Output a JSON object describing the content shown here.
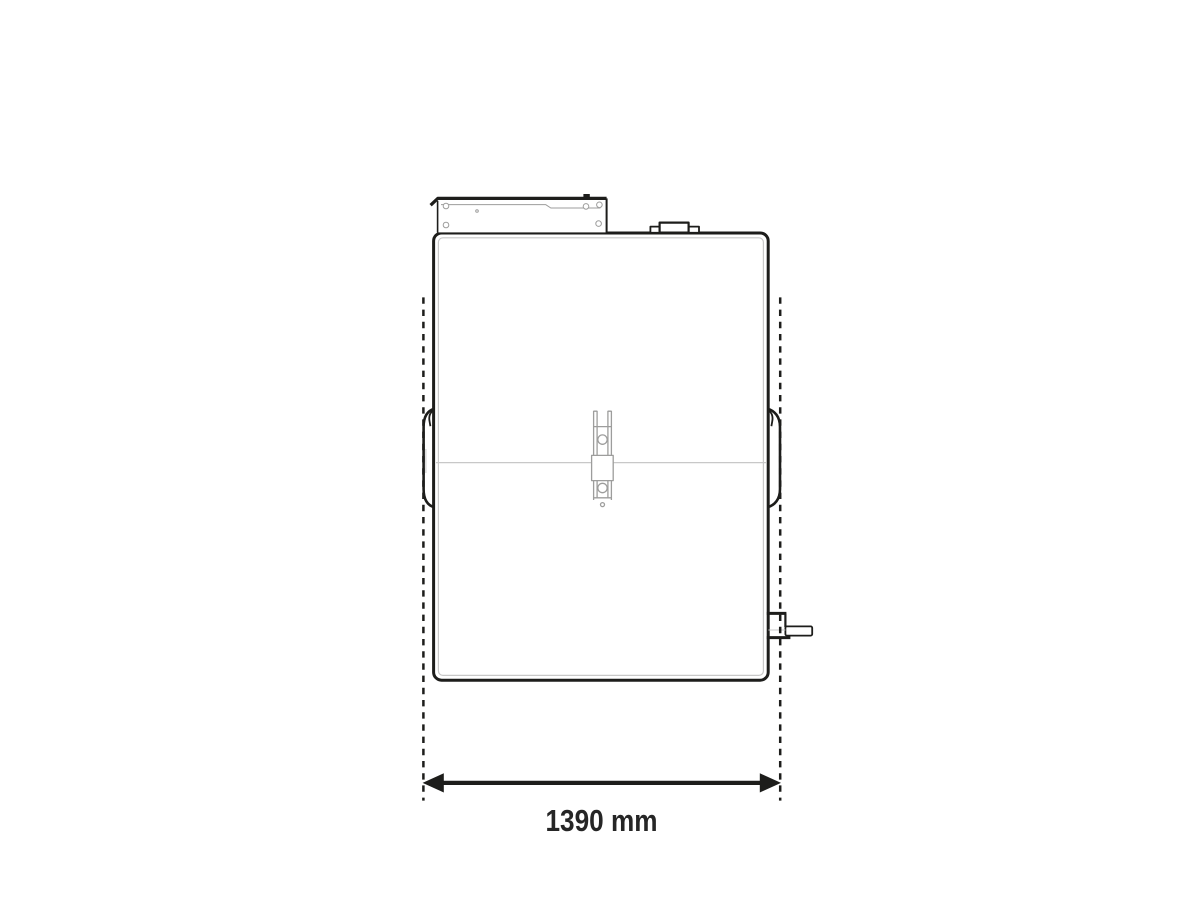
{
  "page": {
    "background": "#ffffff"
  },
  "drawing": {
    "dimension": {
      "label": "1390 mm",
      "value": 1390,
      "unit": "mm"
    },
    "colors": {
      "outline": "#1d1d1b",
      "detail": "#9d9d9c",
      "thin": "#c8c8c8",
      "text": "#262626",
      "fill": "#ffffff"
    }
  }
}
